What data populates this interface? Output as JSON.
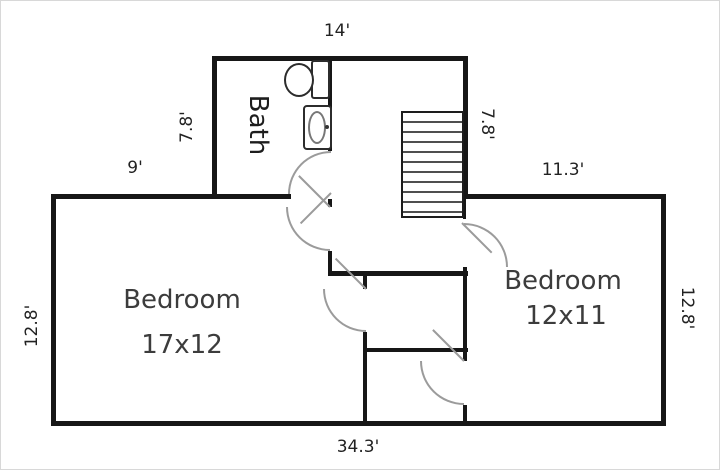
{
  "colors": {
    "background": "#ffffff",
    "wall": "#171717",
    "door_arc": "#9b9b9b",
    "stair_tread": "#4f4f4f",
    "dimension_text": "#222222",
    "room_text": "#3c3c3c"
  },
  "rooms": {
    "bath": {
      "label": "Bath"
    },
    "bedroom_left": {
      "label": "Bedroom",
      "size": "17x12"
    },
    "bedroom_right": {
      "label": "Bedroom",
      "size": "12x11"
    }
  },
  "dimensions": {
    "top_width": "14'",
    "bath_side": "7.8'",
    "stairs_side": "7.8'",
    "upper_left_offset": "9'",
    "upper_right_offset": "11.3'",
    "left_depth": "12.8'",
    "right_depth": "12.8'",
    "bottom_width": "34.3'"
  },
  "symbols": {
    "toilet": "toilet-icon",
    "sink": "sink-icon",
    "staircase": "staircase-icon",
    "doors": [
      "bath-door",
      "bedroom-left-door",
      "bedroom-left-closet-door",
      "bedroom-right-door",
      "bedroom-right-closet-door"
    ]
  }
}
